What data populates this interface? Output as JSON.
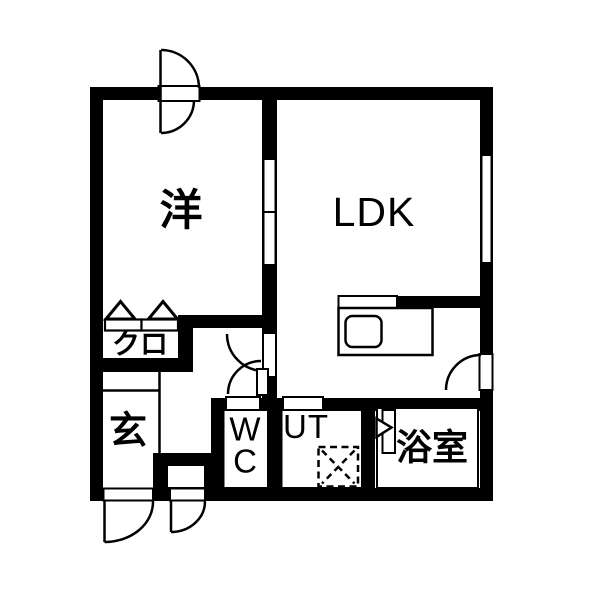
{
  "floorplan": {
    "rooms": {
      "western": "洋",
      "ldk": "LDK",
      "closet": "クロ",
      "entrance": "玄",
      "wc": "W\nC",
      "utility": "UT",
      "bathroom": "浴室"
    },
    "symbols": [
      "double-swing-door-top",
      "hinged-door-hall-to-ldk",
      "hinged-door-wc",
      "hinged-door-balcony",
      "entrance-door-large",
      "entrance-door-small",
      "folding-closet-door",
      "bathroom-door-triangle",
      "kitchen-counter-with-sink",
      "washing-machine-dashed",
      "window-right-wall",
      "window-interior-wall"
    ],
    "colors": {
      "wall": "#000000",
      "background": "#ffffff",
      "line": "#000000"
    }
  }
}
